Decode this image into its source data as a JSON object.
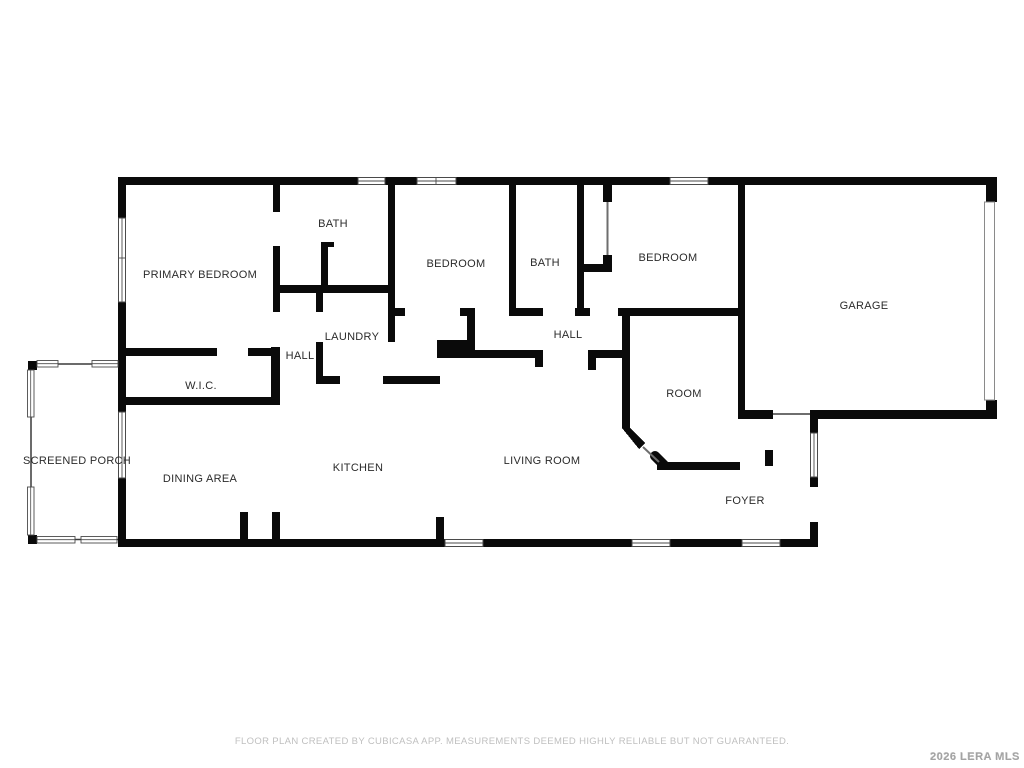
{
  "rooms": [
    {
      "id": "primary-bedroom",
      "label": "PRIMARY BEDROOM"
    },
    {
      "id": "bath-1",
      "label": "BATH"
    },
    {
      "id": "bedroom-1",
      "label": "BEDROOM"
    },
    {
      "id": "bath-2",
      "label": "BATH"
    },
    {
      "id": "bedroom-2",
      "label": "BEDROOM"
    },
    {
      "id": "garage",
      "label": "GARAGE"
    },
    {
      "id": "laundry",
      "label": "LAUNDRY"
    },
    {
      "id": "hall-1",
      "label": "HALL"
    },
    {
      "id": "hall-2",
      "label": "HALL"
    },
    {
      "id": "wic",
      "label": "W.I.C."
    },
    {
      "id": "room",
      "label": "ROOM"
    },
    {
      "id": "screened-porch",
      "label": "SCREENED PORCH"
    },
    {
      "id": "dining-area",
      "label": "DINING AREA"
    },
    {
      "id": "kitchen",
      "label": "KITCHEN"
    },
    {
      "id": "living-room",
      "label": "LIVING ROOM"
    },
    {
      "id": "foyer",
      "label": "FOYER"
    }
  ],
  "footer": {
    "disclaimer": "FLOOR PLAN CREATED BY CUBICASA APP. MEASUREMENTS DEEMED HIGHLY RELIABLE BUT NOT GUARANTEED."
  },
  "watermark": {
    "label": "2026 LERA MLS"
  },
  "colors": {
    "wall": "#0a0a0a",
    "background": "#ffffff",
    "window_frame": "#4a4a4a",
    "door_line": "#6e6e6e",
    "label_text": "#2b2b2b",
    "disclaimer_text": "#bfbfbf",
    "watermark_text": "#a3a3a3"
  }
}
